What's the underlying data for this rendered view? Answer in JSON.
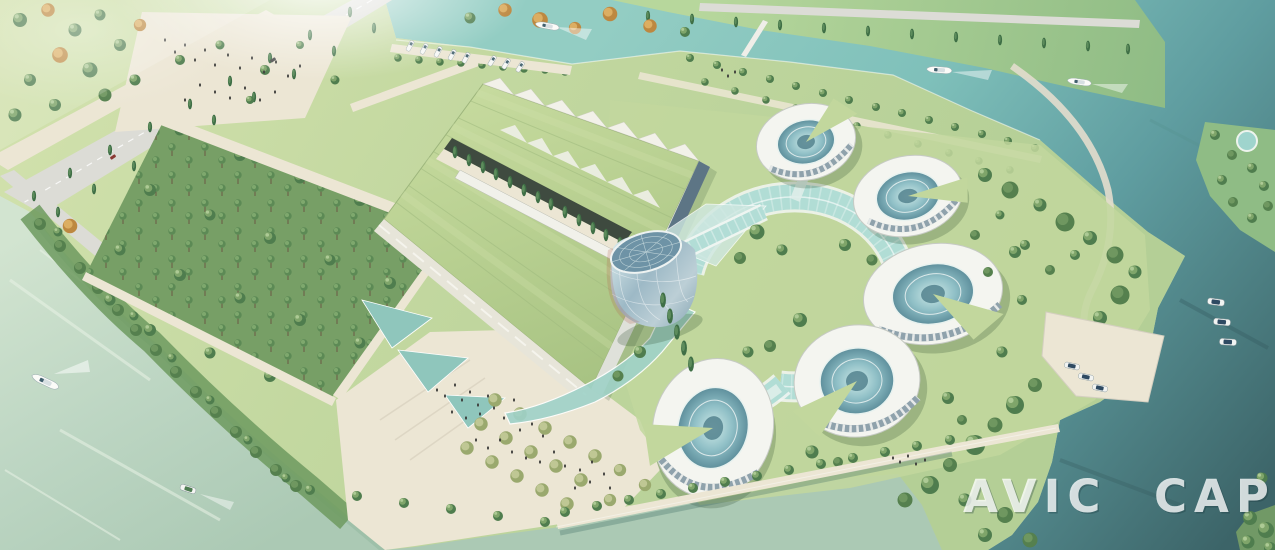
{
  "title": "Aerial architectural rendering of riverside campus",
  "watermark": {
    "text": "AVIC CAPDI",
    "color": "#ffffff"
  },
  "palette": {
    "grass": "#c2d79d",
    "grass_dark": "#a9c689",
    "forest_ground": "#779f66",
    "path_cream": "#ece6d4",
    "road_grey": "#dcdcd6",
    "building_white": "#f3f3ec",
    "glass_teal": "#aedbd4",
    "glass_deep": "#5d7585",
    "roof_green": "#b9cf92",
    "water_teal": "#85c4bb",
    "water_pale": "#c2d8c6",
    "water_dark": "#3f676c",
    "tree_green": "#4f7d4e",
    "tree_light": "#7fa56a",
    "tree_olive": "#9aa96e",
    "tree_autumn": "#bd8840",
    "shadow_green": "#2f4f31"
  },
  "scene": {
    "ring_buildings_count": 5,
    "moving_boats_count": 5,
    "marina_boats_count": 8,
    "dock_boats_count": 6
  }
}
